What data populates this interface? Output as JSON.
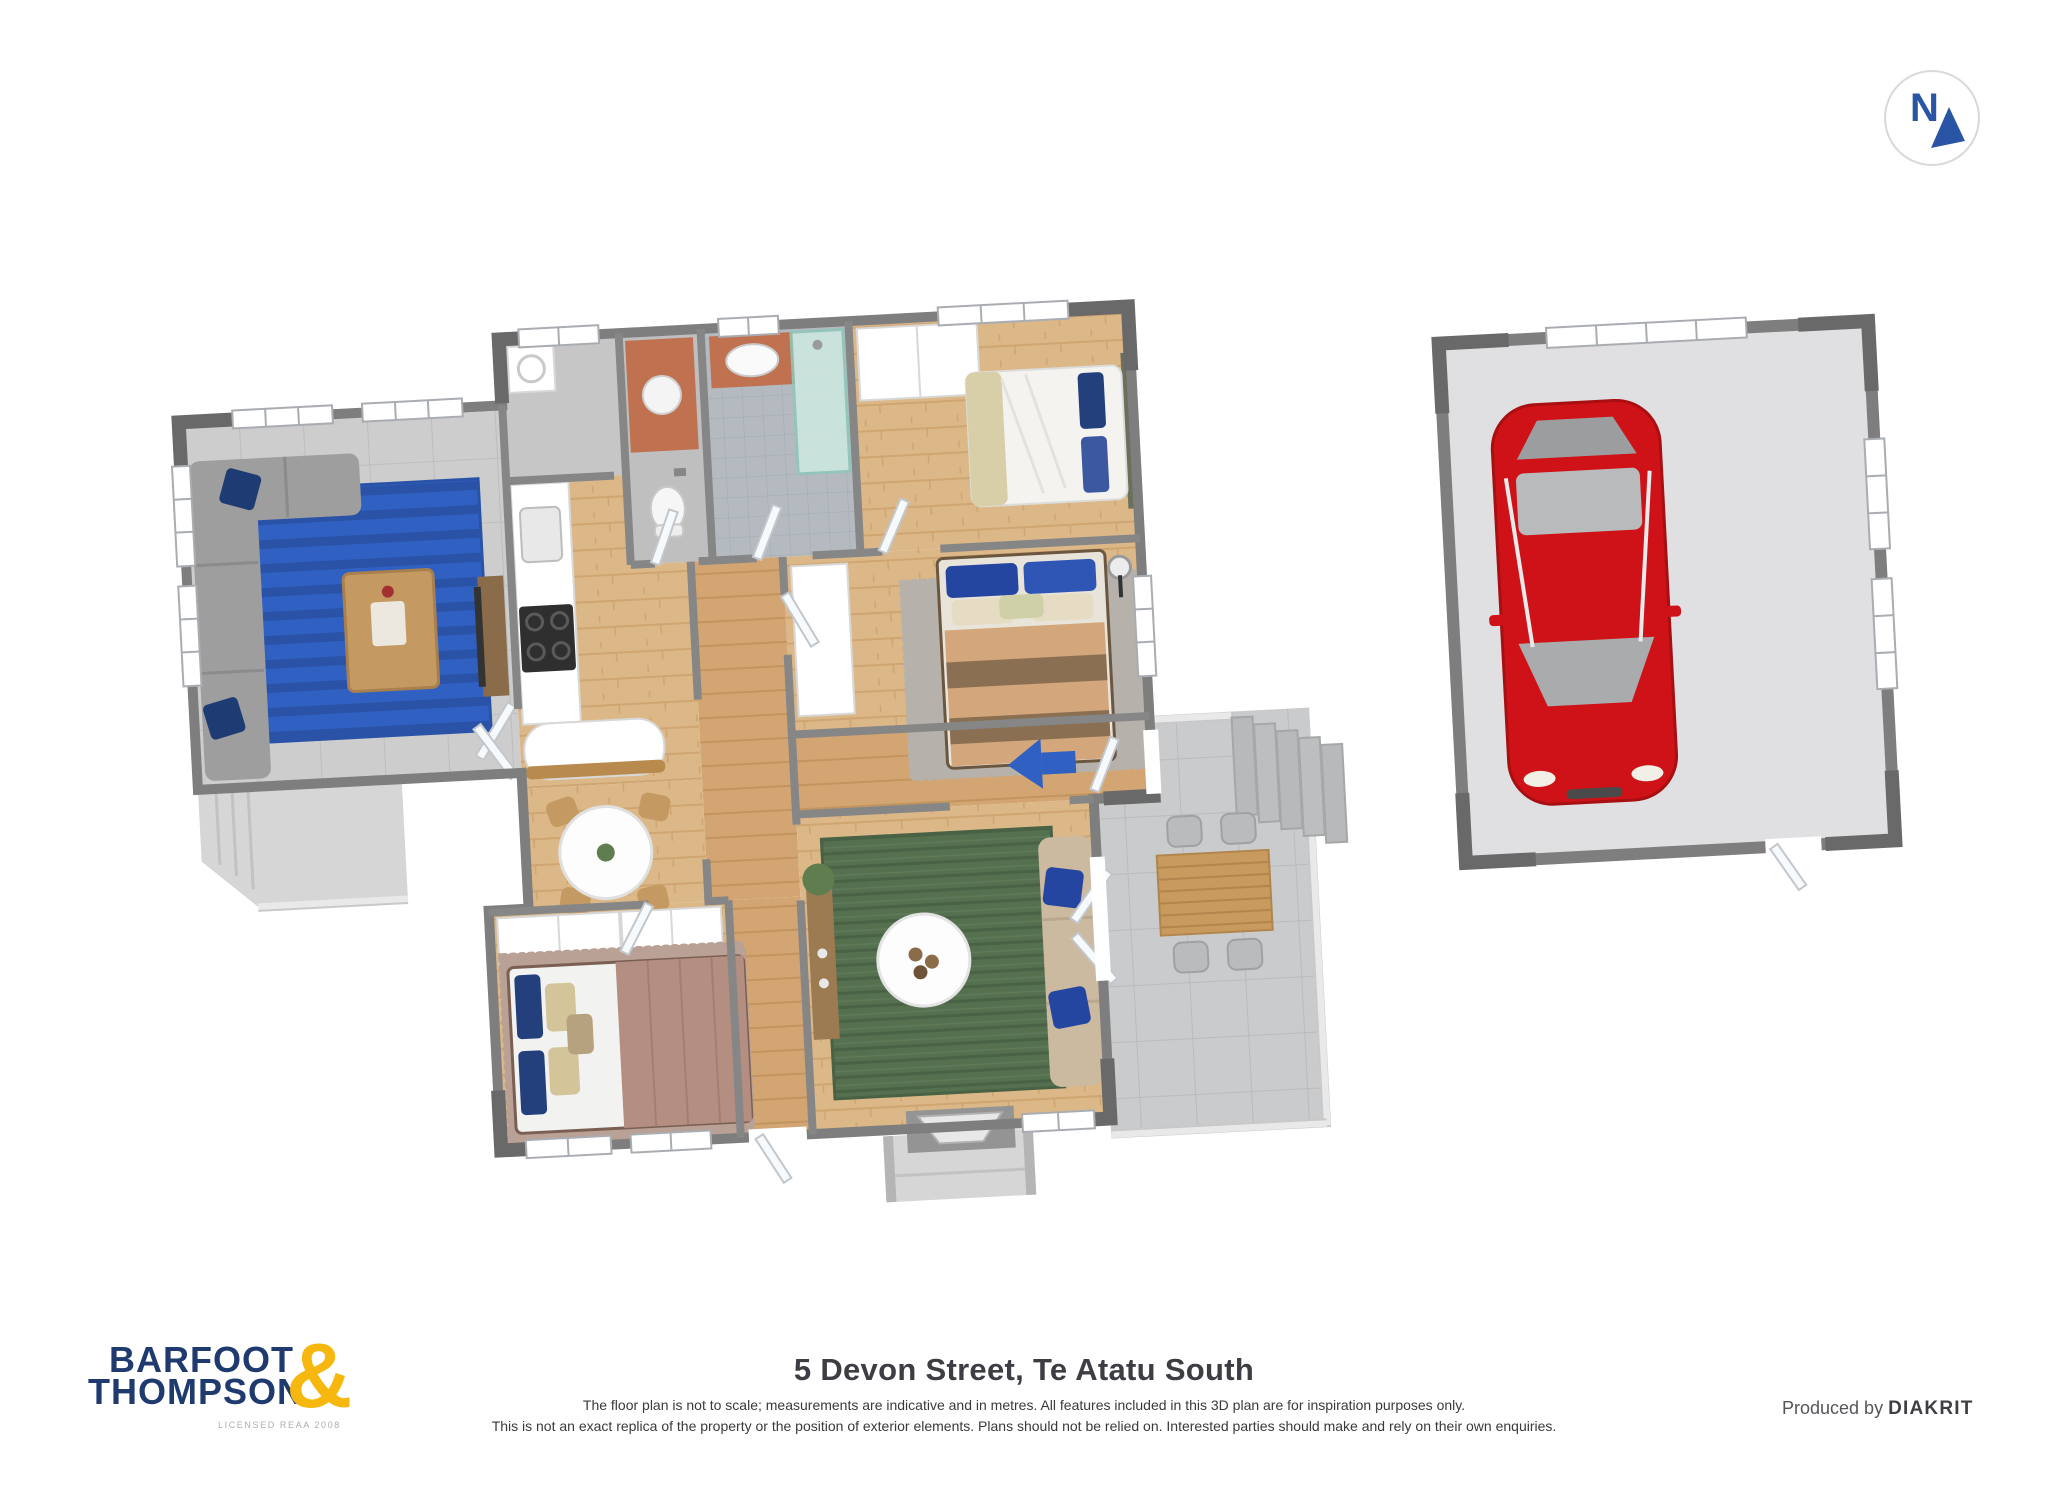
{
  "compass": {
    "label": "N"
  },
  "footer": {
    "logo": {
      "line1": "BARFOOT",
      "line2": "THOMPSON",
      "ampersand": "&",
      "subtext": "LICENSED REAA 2008"
    },
    "title": "5 Devon Street, Te Atatu South",
    "disclaimer_line1": "The floor plan is not to scale; measurements are indicative and in metres. All features included in this 3D plan are for inspiration purposes only.",
    "disclaimer_line2": "This is not an exact replica of the property or the position of exterior elements. Plans should not be relied on. Interested parties should make and rely on their own enquiries.",
    "produced_by": "Produced by",
    "producer_brand": "DIAKRIT"
  },
  "colors": {
    "logo_navy": "#1f3a6e",
    "logo_gold": "#f6b80f",
    "compass_navy": "#2a55a5",
    "car_red": "#ce1217",
    "rug_blue": "#3061c2",
    "rug_green": "#55704f",
    "wood_floor": "#dcb888",
    "tile_gray": "#cdcdcd",
    "wall_gray": "#7e7e7e",
    "deck_gray": "#c9cbcd"
  }
}
